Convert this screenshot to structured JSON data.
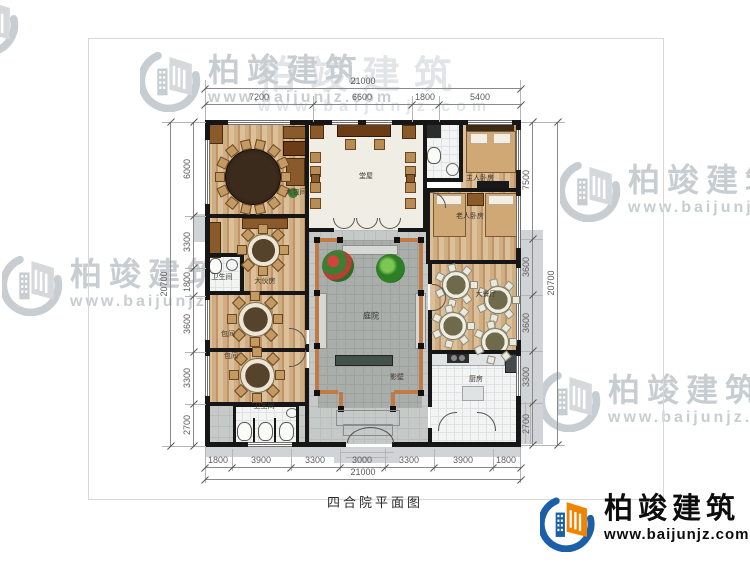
{
  "drawing": {
    "title": "四合院平面图"
  },
  "brand": {
    "name": "柏竣建筑",
    "url": "www.baijunjz.com"
  },
  "watermark": {
    "name": "柏竣建筑",
    "url": "www.baijunjz.com"
  },
  "dimensions": {
    "top": {
      "total": "21000",
      "segments": [
        "7200",
        "6600",
        "1800",
        "5400"
      ]
    },
    "bottom": {
      "total": "21000",
      "segments": [
        "1800",
        "3900",
        "3300",
        "3000",
        "3300",
        "3900",
        "1800"
      ]
    },
    "left": {
      "total": "20700",
      "segments": [
        "6000",
        "3300",
        "1800",
        "3600",
        "3300",
        "2700"
      ]
    },
    "right": {
      "total": "20700",
      "segments": [
        "7500",
        "3600",
        "3600",
        "3300",
        "2700"
      ]
    }
  },
  "rooms": {
    "hall": "堂屋",
    "big_private_room": "大包间",
    "master_bedroom": "主人卧房",
    "elder_bedroom": "老人卧房",
    "family_dining": "大伙房",
    "bathroom_mid": "卫生间",
    "private_room_1": "包间",
    "private_room_2": "包间",
    "main_dining": "大餐厅",
    "kitchen": "厨房",
    "courtyard": "庭院",
    "screen_wall": "影壁",
    "bathroom_public": "卫生间"
  }
}
